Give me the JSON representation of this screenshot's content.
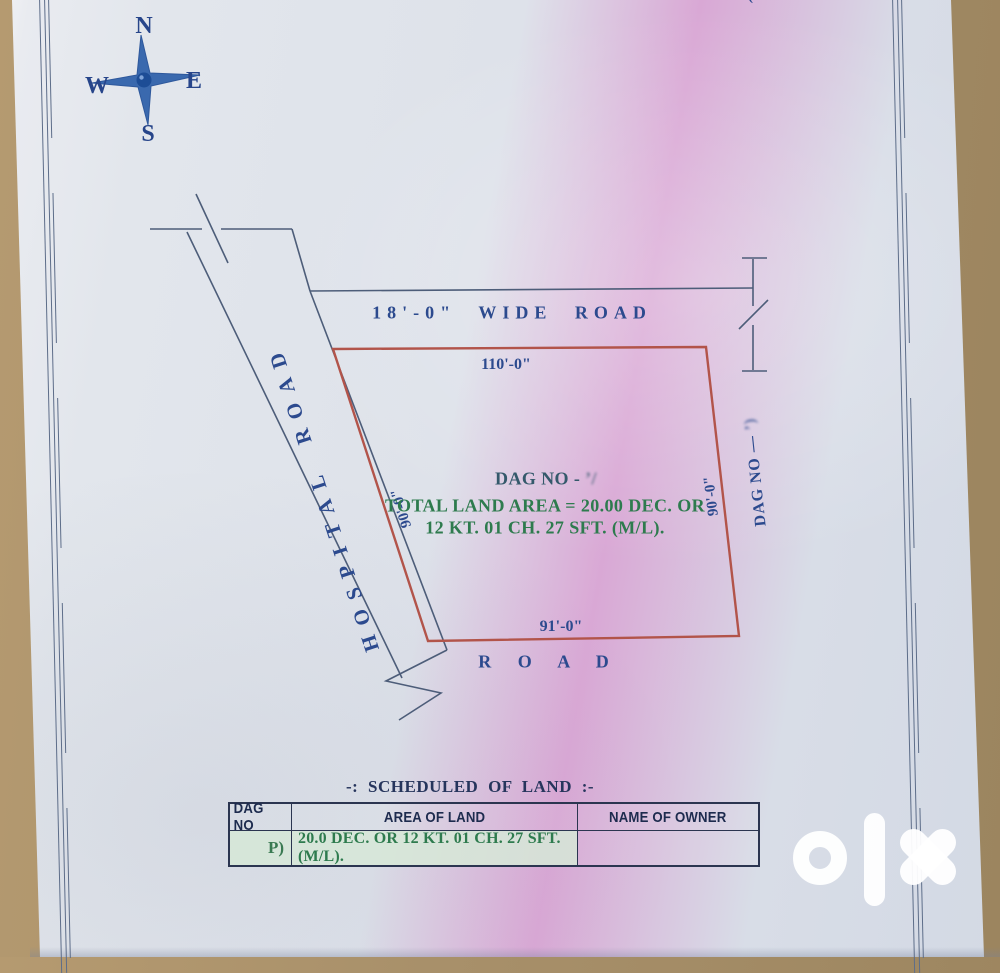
{
  "page": {
    "top_cutoff_text": "(—————— ——— — —)"
  },
  "compass": {
    "north": "N",
    "south": "S",
    "east": "E",
    "west": "W"
  },
  "roads": {
    "wide_road_label": "18'-0\" WIDE ROAD",
    "hospital_road_label": "HOSPITAL ROAD",
    "bottom_road_label": "R O A D"
  },
  "plot": {
    "top_dim": "110'-0\"",
    "left_dim": "90'-0\"",
    "right_dim": "90'-0\"",
    "bottom_dim": "91'-0\"",
    "dag_no_label": "DAG NO - ",
    "dag_no_redacted": "’/",
    "area_line1": "TOTAL LAND AREA = 20.00 DEC. OR",
    "area_line2": "12 KT. 01 CH. 27 SFT. (M/L).",
    "right_dag_label": "DAG NO — ",
    "right_dag_suffix": "’)"
  },
  "schedule": {
    "title": "-: SCHEDULED  OF  LAND :-",
    "headers": [
      "DAG NO",
      "AREA OF LAND",
      "NAME OF OWNER"
    ],
    "rows": [
      [
        "P)",
        "20.0 DEC. OR 12 KT. 01 CH. 27 SFT. (M/L).",
        ""
      ]
    ]
  },
  "watermark": {
    "logo": "olx"
  },
  "colors": {
    "plot_outline": "#b2544a",
    "drawing_blue": "#2c4a8e",
    "green_text": "#2e7b4e",
    "highlight_green": "#d7e7d8",
    "paper": "#dfe3ea",
    "background": "#a8906a"
  }
}
